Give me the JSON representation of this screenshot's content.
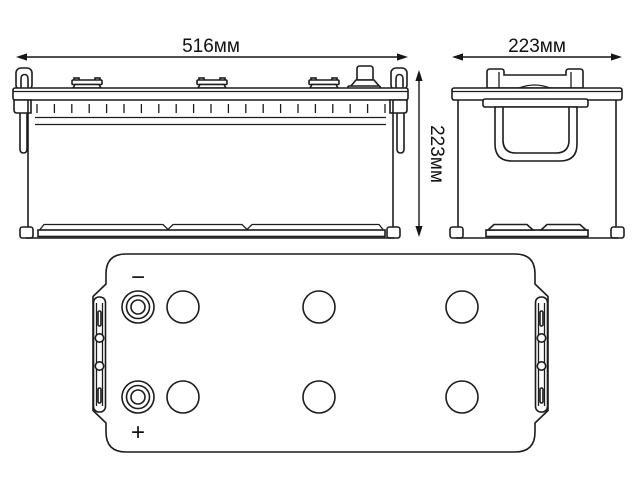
{
  "diagram": {
    "subject": "truck-battery-dimensional-drawing",
    "dimensions": {
      "width_label": "516мм",
      "depth_label": "223мм",
      "height_label": "223мм"
    },
    "top_view": {
      "negative_label": "−",
      "positive_label": "+"
    },
    "style": {
      "background_color": "#ffffff",
      "line_color": "#1c1c1c",
      "text_color": "#111111"
    }
  }
}
